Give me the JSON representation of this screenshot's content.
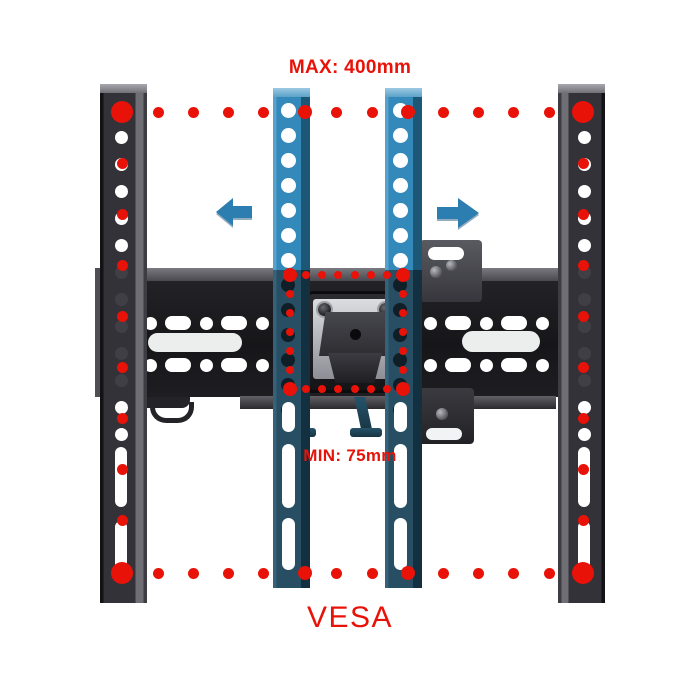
{
  "labels": {
    "max": "MAX: 400mm",
    "min": "MIN: 75mm",
    "vesa": "VESA"
  },
  "colors": {
    "annotation_red": "#e81208",
    "arrow_blue": "#2d7eb0",
    "rail_blue_bright": "#3489bb",
    "rail_blue_dark": "#264c60",
    "rail_black": "#303034",
    "plate_black": "#1d1d20",
    "background": "#ffffff"
  },
  "figure": {
    "outer_dots": {
      "left_x": 122,
      "right_x": 583,
      "top_y": 112,
      "bottom_y": 573,
      "row_xs": [
        158,
        193,
        228,
        263,
        336,
        372,
        443,
        478,
        513,
        549
      ],
      "mid_xs": [
        305,
        408
      ],
      "col_ys": [
        163,
        214,
        265,
        316,
        367,
        418,
        469,
        520
      ],
      "r_corner": 11,
      "r_mid": 7,
      "r_dot": 5.5
    },
    "inner_dots": {
      "left_x": 290,
      "right_x": 403,
      "top_y": 275,
      "bottom_y": 389,
      "row_xs": [
        306,
        322,
        338,
        355,
        371,
        387
      ],
      "col_ys": [
        294,
        313,
        332,
        351,
        370
      ],
      "r_corner": 7,
      "r_dot": 4.2
    },
    "black_rails": {
      "top": 84,
      "xs": [
        100,
        558
      ],
      "hole_cx": [
        121,
        584
      ],
      "holes": {
        "start": 110,
        "step": 27,
        "end": 436,
        "d": 13
      },
      "white_above": 260,
      "white_below": 402,
      "slots": [
        {
          "y": 447,
          "h": 60
        },
        {
          "y": 521,
          "h": 57
        }
      ],
      "slot_w": 12
    },
    "blue_rails": {
      "top": 88,
      "xs": [
        273,
        385
      ],
      "hole_cx": [
        288,
        400
      ],
      "holes_bright": {
        "start": 110,
        "step": 25,
        "end": 262,
        "d": 15
      },
      "holes_mid": {
        "start": 285,
        "step": 25,
        "end": 412,
        "d": 14
      },
      "slots": [
        {
          "y": 402,
          "h": 30
        },
        {
          "y": 444,
          "h": 64
        },
        {
          "y": 518,
          "h": 52
        }
      ],
      "slot_w": 13
    },
    "plate": {
      "x": 95,
      "y": 281,
      "hole_rows": [
        323,
        365
      ],
      "hx_start": 150,
      "hx_step": 28,
      "hx_end": 547,
      "hole_d": 13,
      "slot_w": 26,
      "slot_h": 14,
      "wide_slots": [
        {
          "x": 148,
          "y": 333,
          "w": 94,
          "h": 19
        },
        {
          "x": 462,
          "y": 331,
          "w": 78,
          "h": 21
        }
      ]
    }
  }
}
